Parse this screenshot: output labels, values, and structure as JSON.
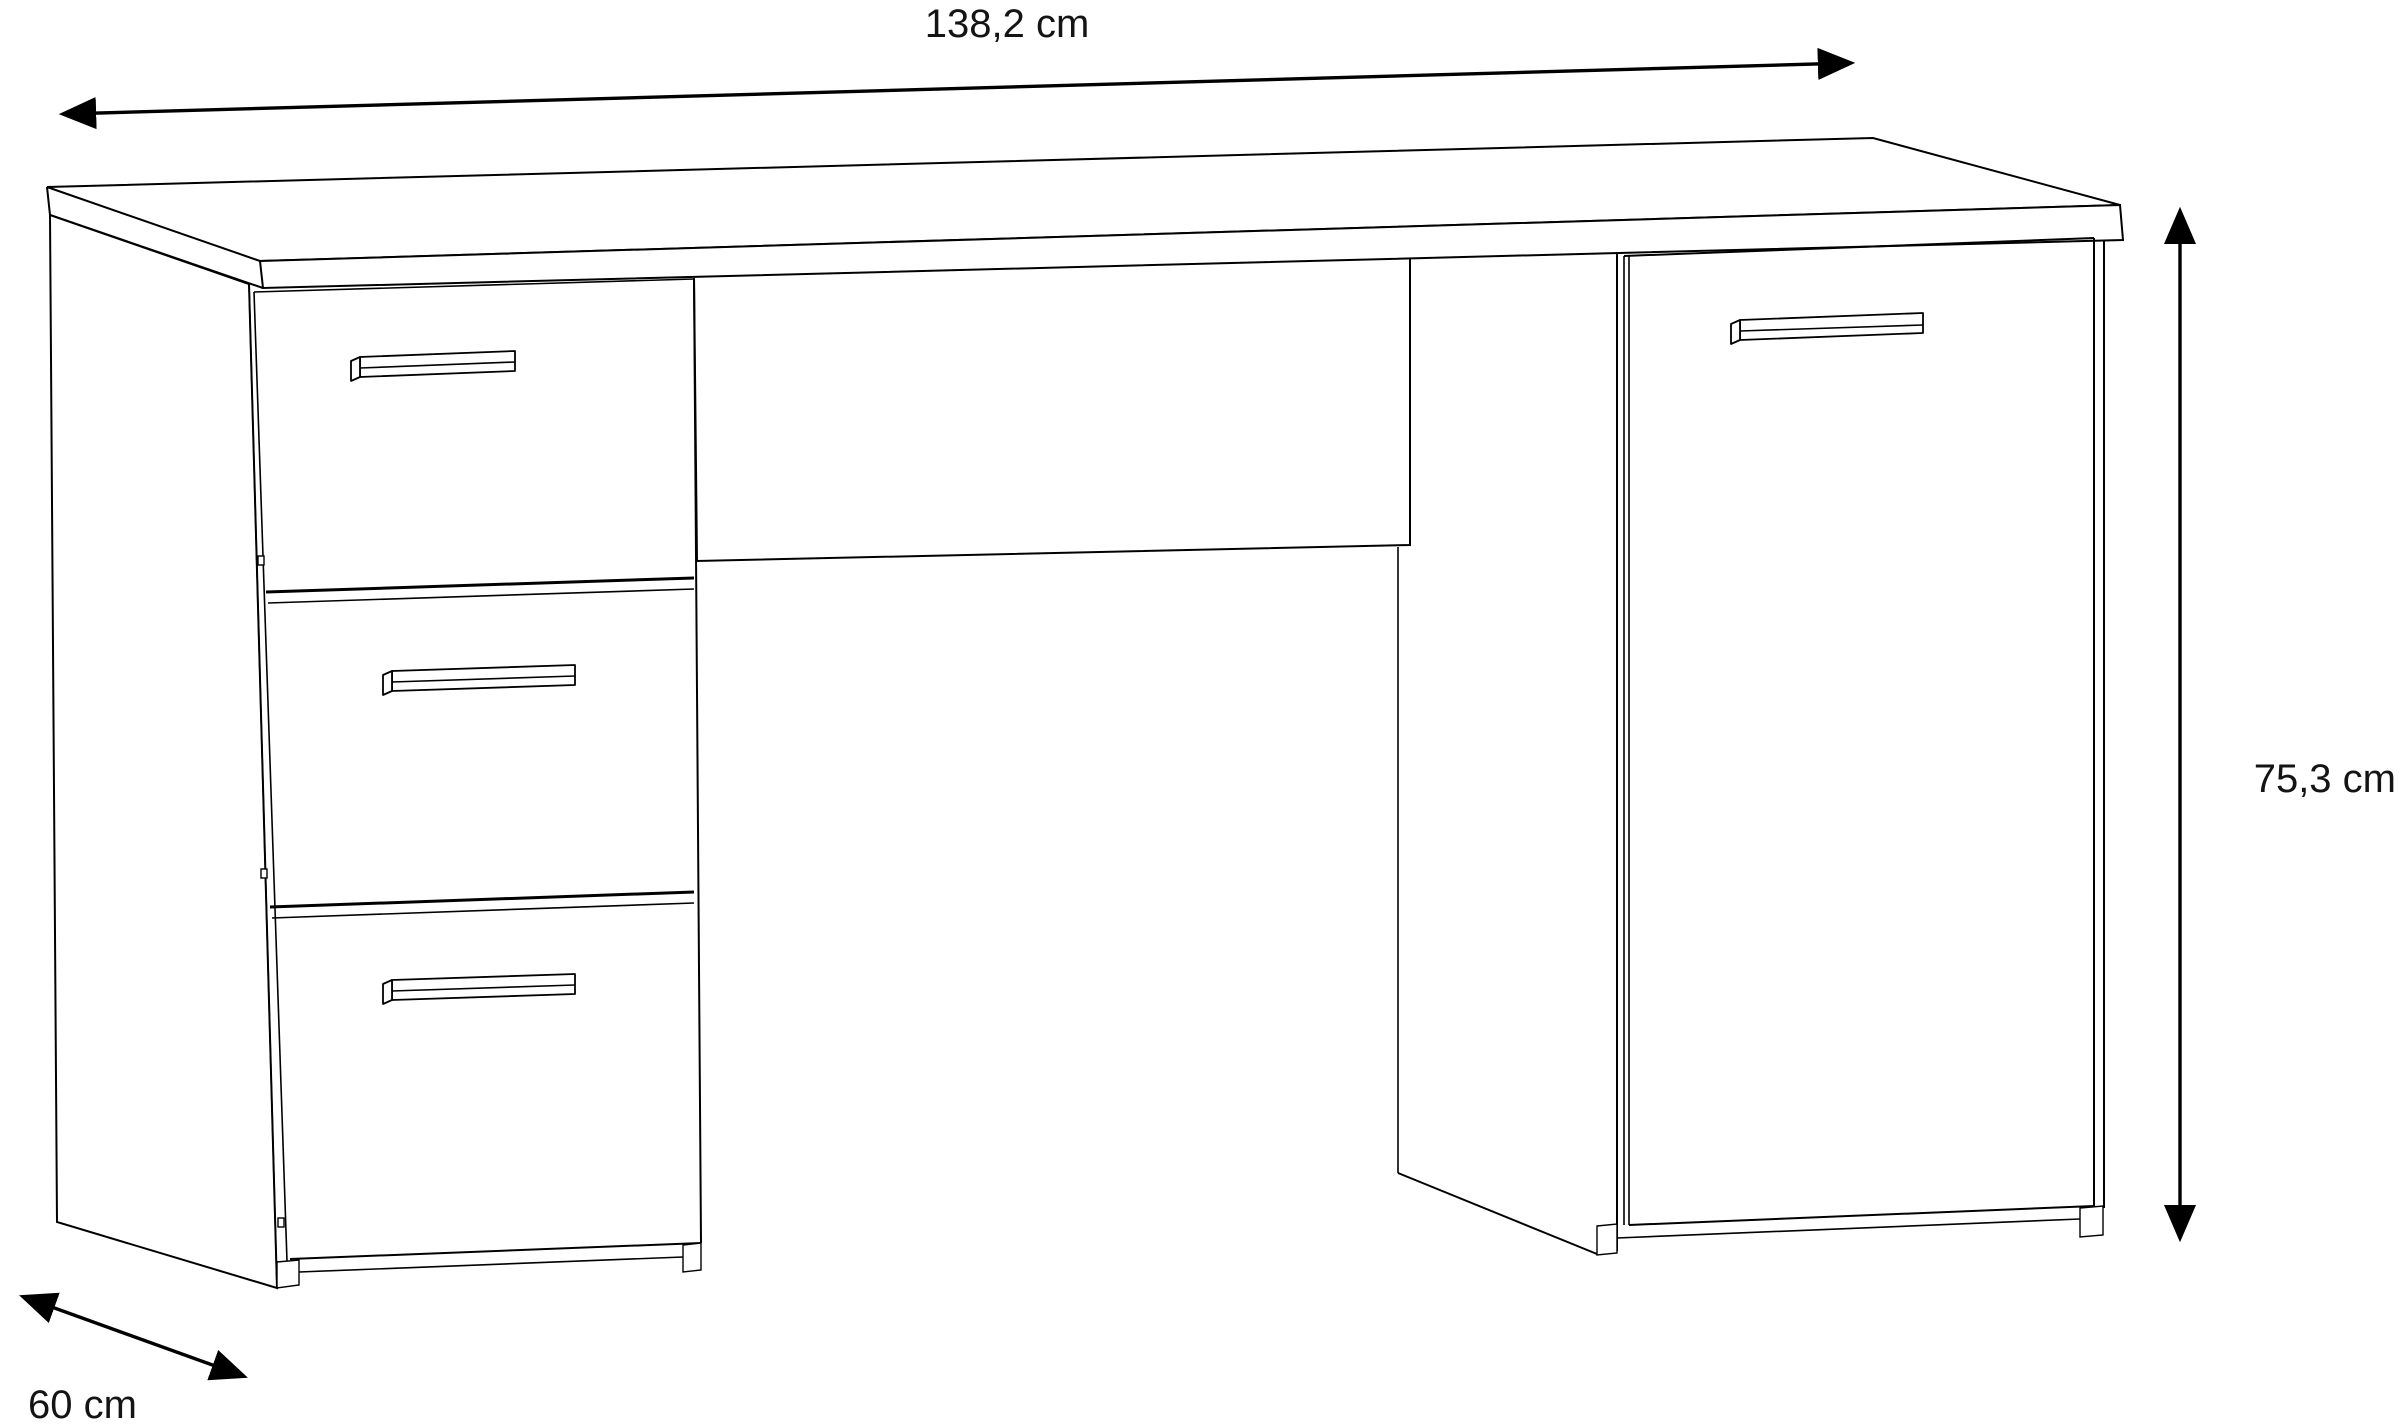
{
  "canvas": {
    "width_px": 2400,
    "height_px": 1424,
    "background_color": "#ffffff",
    "line_color": "#000000",
    "text_color": "#141414"
  },
  "diagram": {
    "type": "furniture-dimension-drawing",
    "subject": "desk with three drawers and one cabinet door",
    "units": "cm",
    "dimensions": {
      "width": {
        "label": "138,2 cm",
        "placement": "top horizontal double-headed arrow"
      },
      "height": {
        "label": "75,3 cm",
        "placement": "right vertical double-headed arrow"
      },
      "depth": {
        "label": "60 cm",
        "placement": "bottom-left diagonal double-headed arrow"
      }
    },
    "parts": {
      "drawer_count": 3,
      "drawer_handle_count": 3,
      "door_count": 1,
      "door_handle_count": 1
    }
  }
}
